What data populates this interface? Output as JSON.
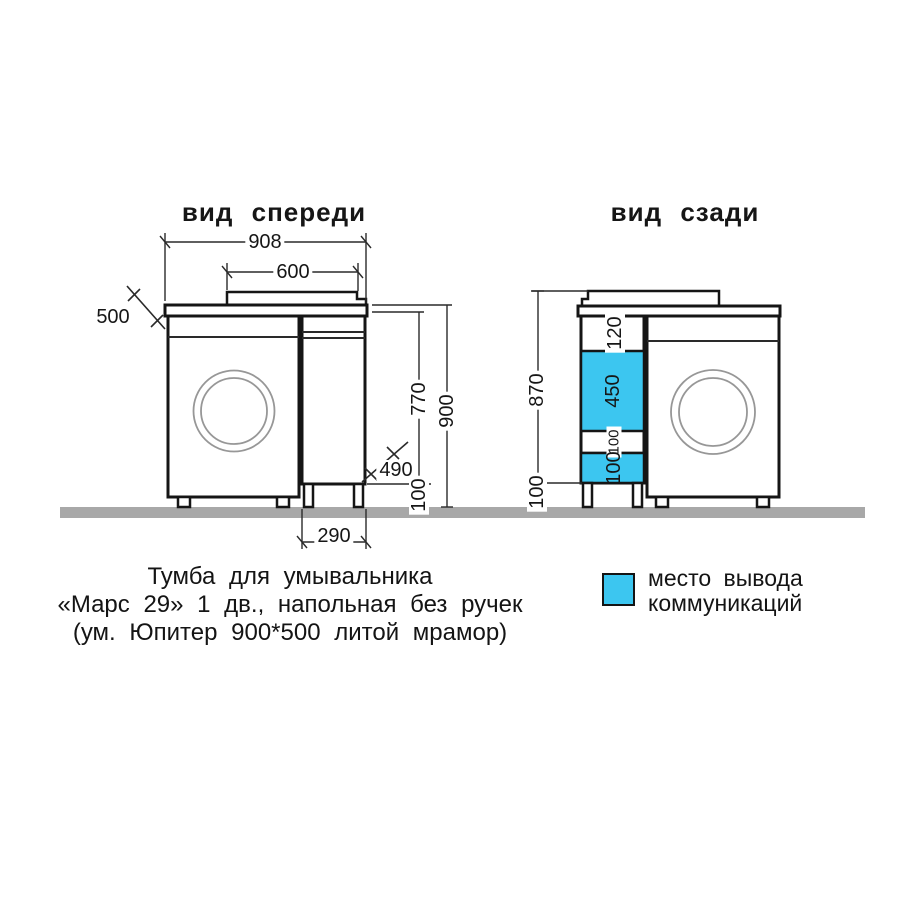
{
  "titles": {
    "front": "вид спереди",
    "back": "вид сзади"
  },
  "front_view": {
    "dims": {
      "total_width": "908",
      "sink_width": "600",
      "depth_top": "500",
      "cabinet_body_height": "770",
      "total_height": "900",
      "cabinet_depth": "490",
      "leg_height": "100",
      "cabinet_width": "290"
    }
  },
  "back_view": {
    "dims": {
      "height_to_top": "870",
      "leg_height": "100"
    },
    "sections": [
      {
        "label": "120",
        "color": "white"
      },
      {
        "label": "450",
        "color": "cyan"
      },
      {
        "label": "100",
        "color": "white"
      },
      {
        "label": "100",
        "color": "cyan"
      }
    ]
  },
  "legend": {
    "swatch_meaning": "communication-outlet-area",
    "line1": "место вывода",
    "line2": "коммуникаций"
  },
  "caption": {
    "line1": "Тумба для умывальника",
    "line2": "«Марс 29» 1 дв., напольная без ручек",
    "line3": "(ум. Юпитер 900*500 литой мрамор)"
  },
  "colors": {
    "accent_cyan": "#3cc6f0",
    "floor_gray": "#a8a8a8",
    "line_black": "#151515",
    "drum_gray": "#979797"
  }
}
